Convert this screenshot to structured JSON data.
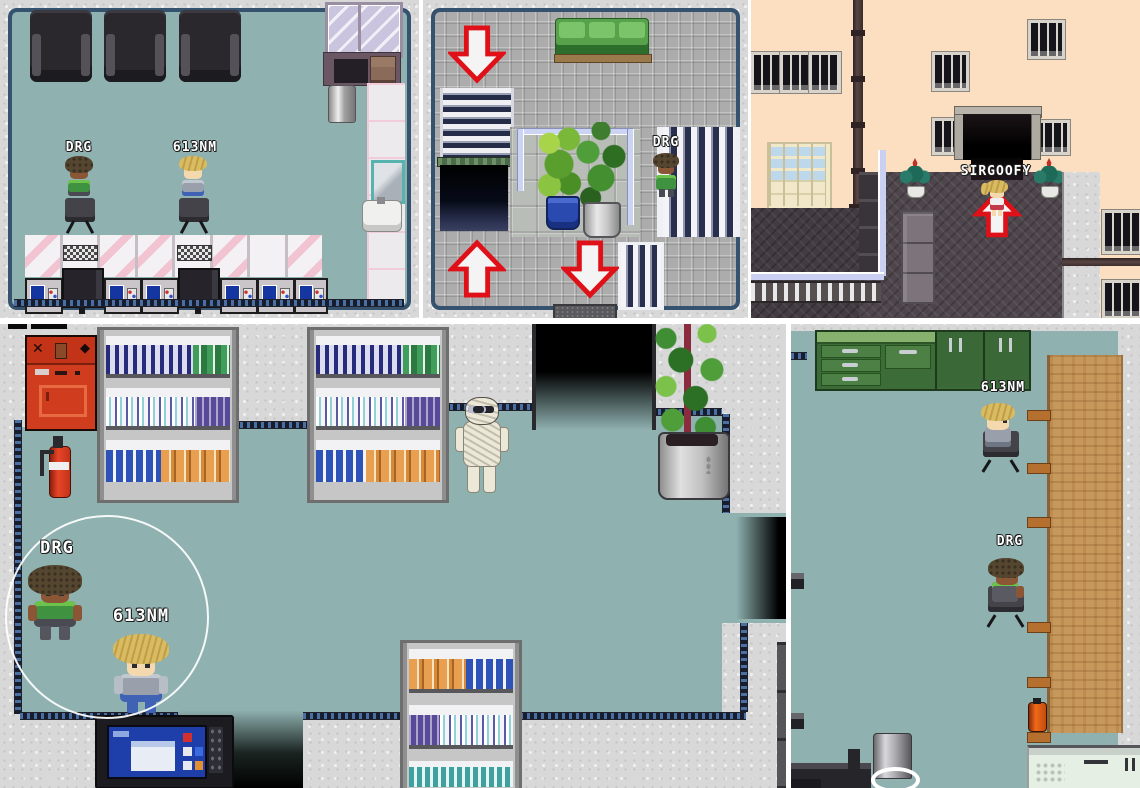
{
  "app": {
    "type": "pixel-rpg-screenshot-collage",
    "panel_count": 5
  },
  "colors": {
    "floor_teal": "#8fb1b0",
    "granite": "#d8d8d8",
    "tile_gray": "#acacac",
    "peach_wall": "#fcdfc1",
    "roof_dark": "#4e464c",
    "wood_table": "#c6985c",
    "cabinet_green": "#3f6f3a",
    "arrow_red": "#e01018",
    "arrow_fill": "#f4f4f4",
    "machine_red": "#cf3d1e",
    "nameplate_text": "#ffffff"
  },
  "icons": {
    "exit-arrow-down": "down-exit-marker",
    "exit-arrow-up": "up-exit-marker",
    "vending-cross": "✕",
    "vending-diamond": "◆"
  },
  "panels": {
    "salon": {
      "name": "laundromat-interior",
      "players": {
        "drg": "DRG",
        "nm": "613NM"
      }
    },
    "lobby": {
      "name": "escalator-lobby",
      "players": {
        "drg": "DRG"
      }
    },
    "street": {
      "name": "town-street-entrance",
      "players": {
        "sirgoofy": "SIRGOOFY"
      }
    },
    "store": {
      "name": "shop-interior",
      "players": {
        "drg": "DRG",
        "nm": "613NM"
      }
    },
    "office": {
      "name": "office-kitchen-room",
      "players": {
        "nm": "613NM",
        "drg": "DRG"
      }
    }
  }
}
